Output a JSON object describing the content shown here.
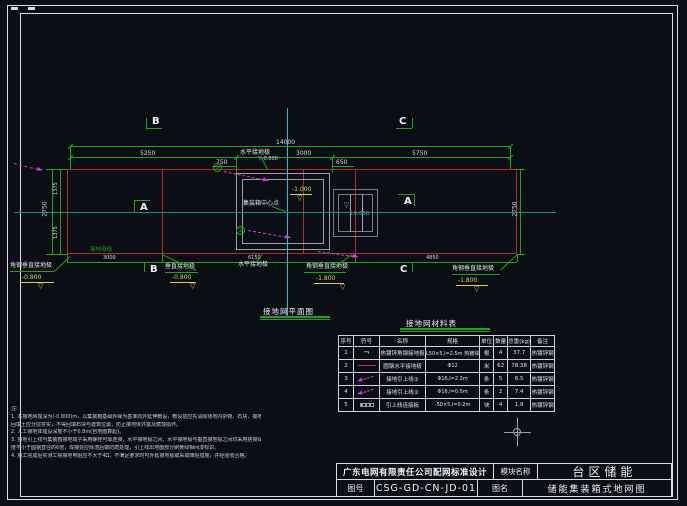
{
  "plan": {
    "title": "接地网平面图",
    "labels": {
      "horiz_top": "水平接地极",
      "horiz_bottom": "水平接地极",
      "angle_left": "角钢垂直接地极",
      "angle_right": "角钢垂直接地极",
      "angle_center": "角钢垂直接地极",
      "rod_mid": "垂直接地极",
      "center_point": "集装箱中心点",
      "bus": "接地母线",
      "callout1": "①",
      "callout2": "②",
      "sect_a": "A",
      "sect_b": "B",
      "sect_c": "C"
    },
    "dims": {
      "top_total": "14000",
      "seg_a": "5250",
      "seg_b": "3000",
      "seg_c": "5750",
      "sub_left": "750",
      "sub_right": "650",
      "left_total": "2750",
      "left_a": "1375",
      "left_b": "1375",
      "right_total": "2750",
      "bot_a": "3000",
      "bot_b": "6150",
      "bot_c": "4850"
    },
    "elevations": {
      "top": "-0.800",
      "corner_left": "-0.800",
      "mid": "-0.800",
      "center": "-1.800",
      "corner_right": "-1.800",
      "container": "-1.000",
      "pad": "±0.000"
    },
    "colors": {
      "grid_red": "#b32b2b",
      "dim_green": "#1ea31e",
      "centerline_cyan": "#22c3cf",
      "lead_magenta": "#d23dd2",
      "elevation_yellow": "#d3d35a"
    }
  },
  "materials": {
    "title": "接地网材料表",
    "headers": [
      "序号",
      "符号",
      "名称",
      "规格",
      "单位",
      "数量",
      "总重(kg)",
      "备注"
    ],
    "rows": [
      {
        "seq": "1",
        "symbol": "angle-steel",
        "name": "热镀锌角钢接地极",
        "spec": "L50×5,l=2.5m 热镀锌",
        "unit": "根",
        "qty": "4",
        "weight": "37.7",
        "remark": "热镀锌钢"
      },
      {
        "seq": "2",
        "symbol": "red-line",
        "name": "圆钢水平接地极",
        "spec": "Φ12",
        "unit": "米",
        "qty": "62",
        "weight": "78.38",
        "remark": "热镀锌钢"
      },
      {
        "seq": "3",
        "symbol": "magenta-arrow",
        "name": "接地引上线①",
        "spec": "Φ16,l=2.2m",
        "unit": "条",
        "qty": "5",
        "weight": "6.5",
        "remark": "热镀锌钢"
      },
      {
        "seq": "4",
        "symbol": "magenta-arrow",
        "name": "接地引上线②",
        "spec": "Φ16,l=0.5m",
        "unit": "条",
        "qty": "2",
        "weight": "7.4",
        "remark": "热镀锌钢"
      },
      {
        "seq": "5",
        "symbol": "plate",
        "name": "引上线连接板",
        "spec": "-50×5,l=0.2m",
        "unit": "块",
        "qty": "4",
        "weight": "1.8",
        "remark": "热镀锌钢"
      }
    ]
  },
  "notes": {
    "title": "注:",
    "lines": [
      "1. 本接地网埋深为(-0.800)m，以集装箱基础外缘为基准向外延伸敷设，敷设前应先清除场地内杂物、石块，接地体回填土,",
      "   回填土应分层夯实，不得回填石块与建筑垃圾，防止接地体外露及腐蚀损坏。",
      "2. 人工接地体埋设深度不小于0.8m(自地面算起)。",
      "3. 接地引上线与集装箱接地端子采用螺栓可靠连接，水平接地极之间、水平接地极与垂直接地极之间均采用搭接焊，搭接长",
      "   度不小于圆钢直径的6倍，焊接处应除渣后做防腐处理，引上线出地面部分刷黄绿相间漆标识。",
      "4. 施工完成后实测工频接地电阻应不大于4Ω，不满足要求时可外延接地极或采取降阻措施，并经验收合格。"
    ]
  },
  "title_block": {
    "company": "广东电网有限责任公司配网标准设计",
    "module_label": "模块名称",
    "module_value": "台区储能",
    "drawing_no_label": "图号",
    "drawing_no": "CSG-GD-CN-JD-01",
    "drawing_name_label": "图名",
    "drawing_name": "储能集装箱式地网图"
  }
}
